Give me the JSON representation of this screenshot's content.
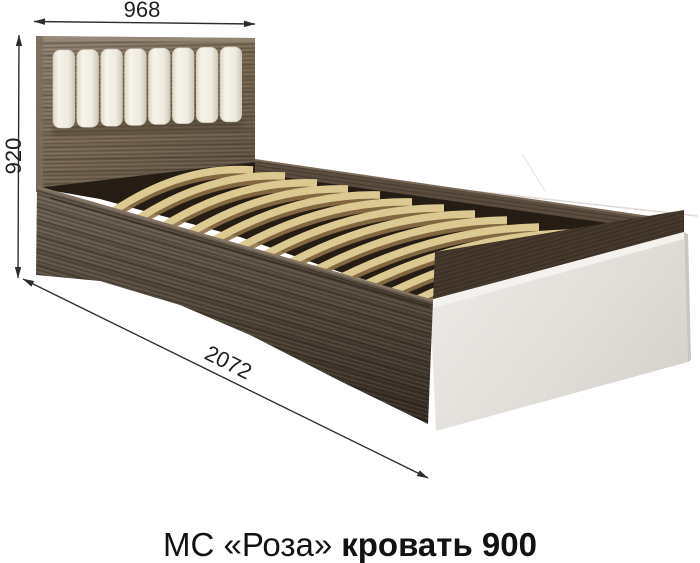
{
  "caption": {
    "series": "МС «Роза»",
    "product": "кровать 900"
  },
  "dimensions": {
    "top_width": "968",
    "left_height": "920",
    "bottom_length": "2072"
  },
  "colors": {
    "background": "#ffffff",
    "dimension_line": "#2e2d2c",
    "dimension_text": "#1f1f1f",
    "caption_text": "#121212",
    "headboard_wood_light": "#8e8071",
    "headboard_wood_dark": "#5f5142",
    "rail_wood_light": "#6e6254",
    "rail_wood_dark": "#332a22",
    "slat_wood": "#dcc891",
    "slat_underside": "#8d7046",
    "cushion_fabric": "#f2efe6",
    "footboard_panel_light": "#efede9",
    "footboard_panel_dark": "#d7d4ce",
    "bed_interior": "#251c14"
  }
}
